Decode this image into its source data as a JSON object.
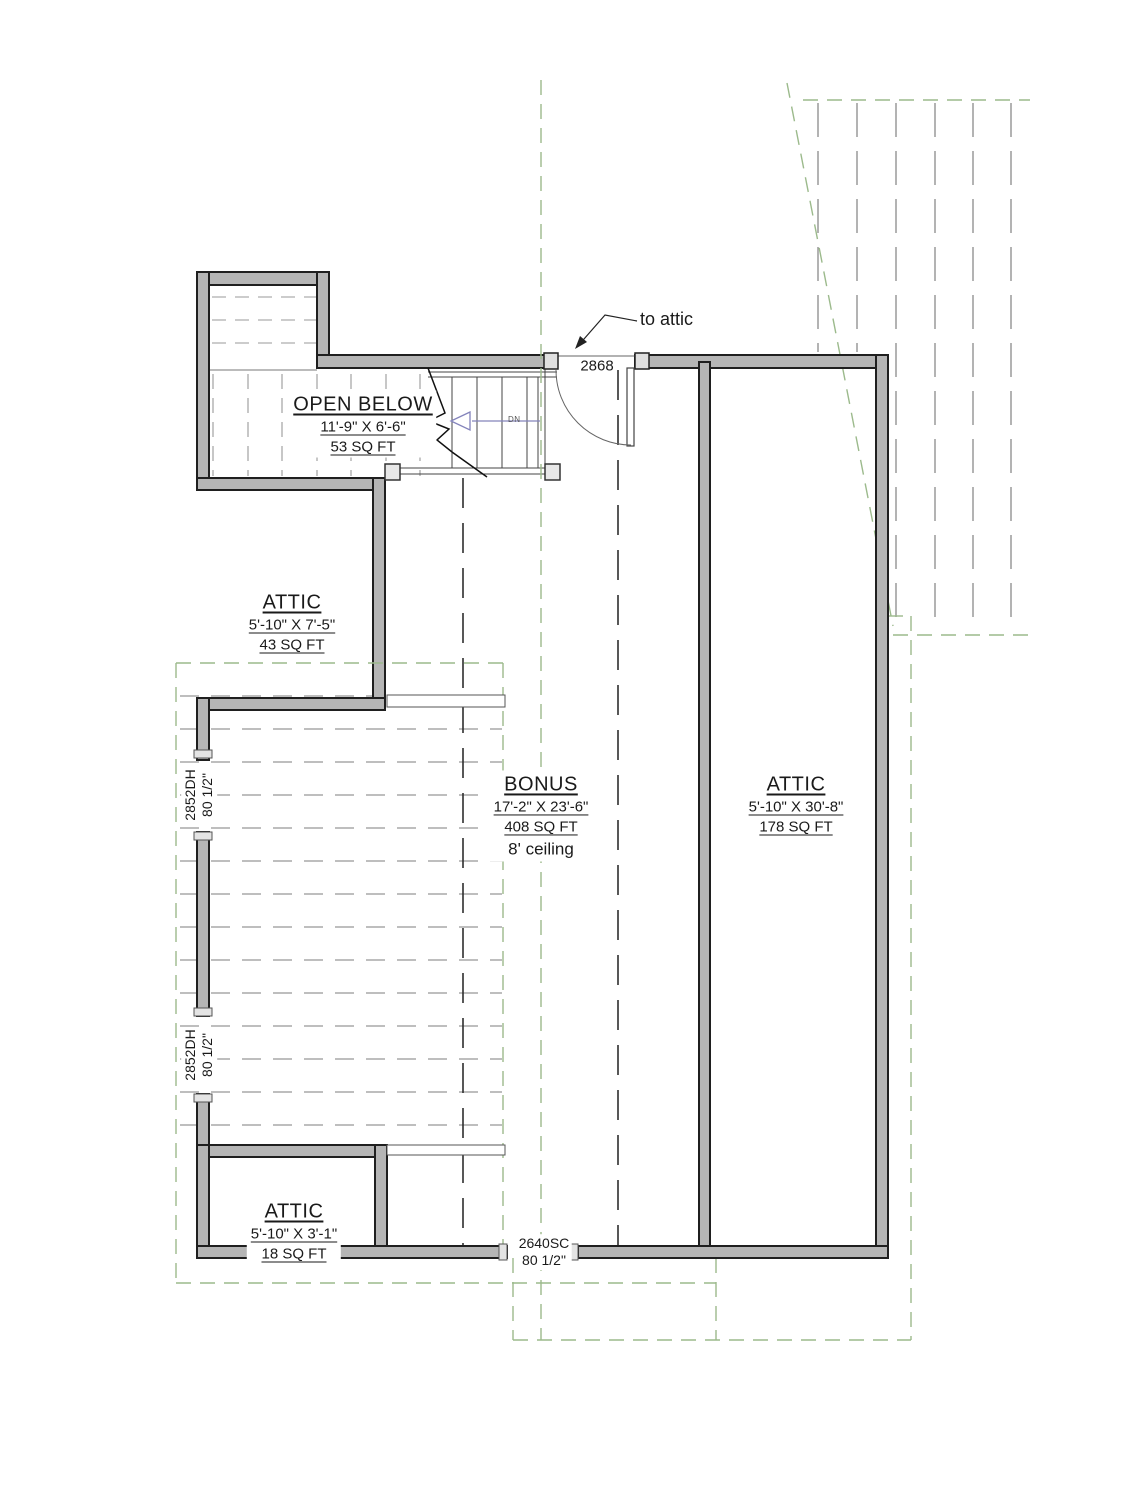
{
  "rooms": {
    "open_below": {
      "name": "OPEN BELOW",
      "dims": "11'-9\" X 6'-6\"",
      "area": "53 SQ FT"
    },
    "attic_upper_left": {
      "name": "ATTIC",
      "dims": "5'-10\" X 7'-5\"",
      "area": "43 SQ FT"
    },
    "bonus": {
      "name": "BONUS",
      "dims": "17'-2\" X 23'-6\"",
      "area": "408 SQ FT",
      "ceiling": "8' ceiling"
    },
    "attic_right": {
      "name": "ATTIC",
      "dims": "5'-10\" X 30'-8\"",
      "area": "178 SQ FT"
    },
    "attic_lower_left": {
      "name": "ATTIC",
      "dims": "5'-10\" X 3'-1\"",
      "area": "18 SQ FT"
    }
  },
  "door": {
    "size_label": "2868",
    "annotation": "to attic"
  },
  "stair": {
    "direction_label": "DN"
  },
  "windows": {
    "left_upper": {
      "label": "2852DH",
      "sill": "80 1/2\""
    },
    "left_lower": {
      "label": "2852DH",
      "sill": "80 1/2\""
    },
    "bottom": {
      "label": "2640SC",
      "sill": "80 1/2\""
    }
  },
  "colors": {
    "wall_fill": "#b5b5b5",
    "wall_edge": "#1f1f1f",
    "roof_line_green": "#9cba8c",
    "dash_gray": "#949494",
    "stair_arrow": "#8383bb"
  }
}
